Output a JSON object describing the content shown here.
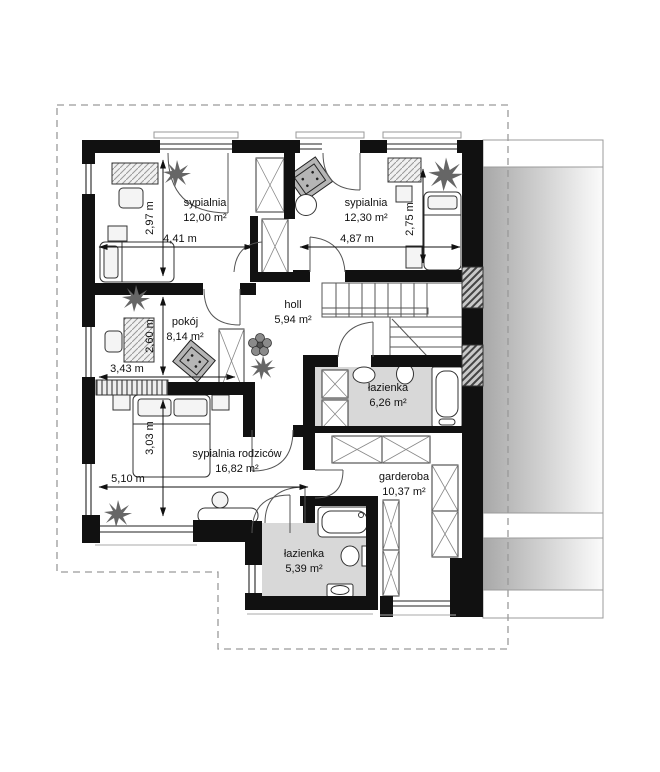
{
  "plan": {
    "title": "Rzut piętra",
    "rooms": [
      {
        "name": "sypialnia",
        "area": "12,00 m²"
      },
      {
        "name": "sypialnia",
        "area": "12,30 m²"
      },
      {
        "name": "pokój",
        "area": "8,14 m²"
      },
      {
        "name": "holl",
        "area": "5,94 m²"
      },
      {
        "name": "łazienka",
        "area": "6,26 m²"
      },
      {
        "name": "sypialnia rodziców",
        "area": "16,82 m²"
      },
      {
        "name": "garderoba",
        "area": "10,37 m²"
      },
      {
        "name": "łazienka",
        "area": "5,39 m²"
      }
    ],
    "dimensions": {
      "bedroom1_height": "2,97 m",
      "bedroom1_width": "4,41 m",
      "bedroom2_width": "4,87 m",
      "bedroom2_height": "2,75 m",
      "pokoj_height": "2,60 m",
      "pokoj_width": "3,43 m",
      "parents_height": "3,03 m",
      "parents_width": "5,10 m"
    },
    "colors": {
      "wall": "#111111",
      "bath_floor": "#d8d8d8",
      "roof_dark": "#a8a8a8",
      "roof_light": "#fafafa",
      "outline": "#9a9a9a"
    }
  }
}
